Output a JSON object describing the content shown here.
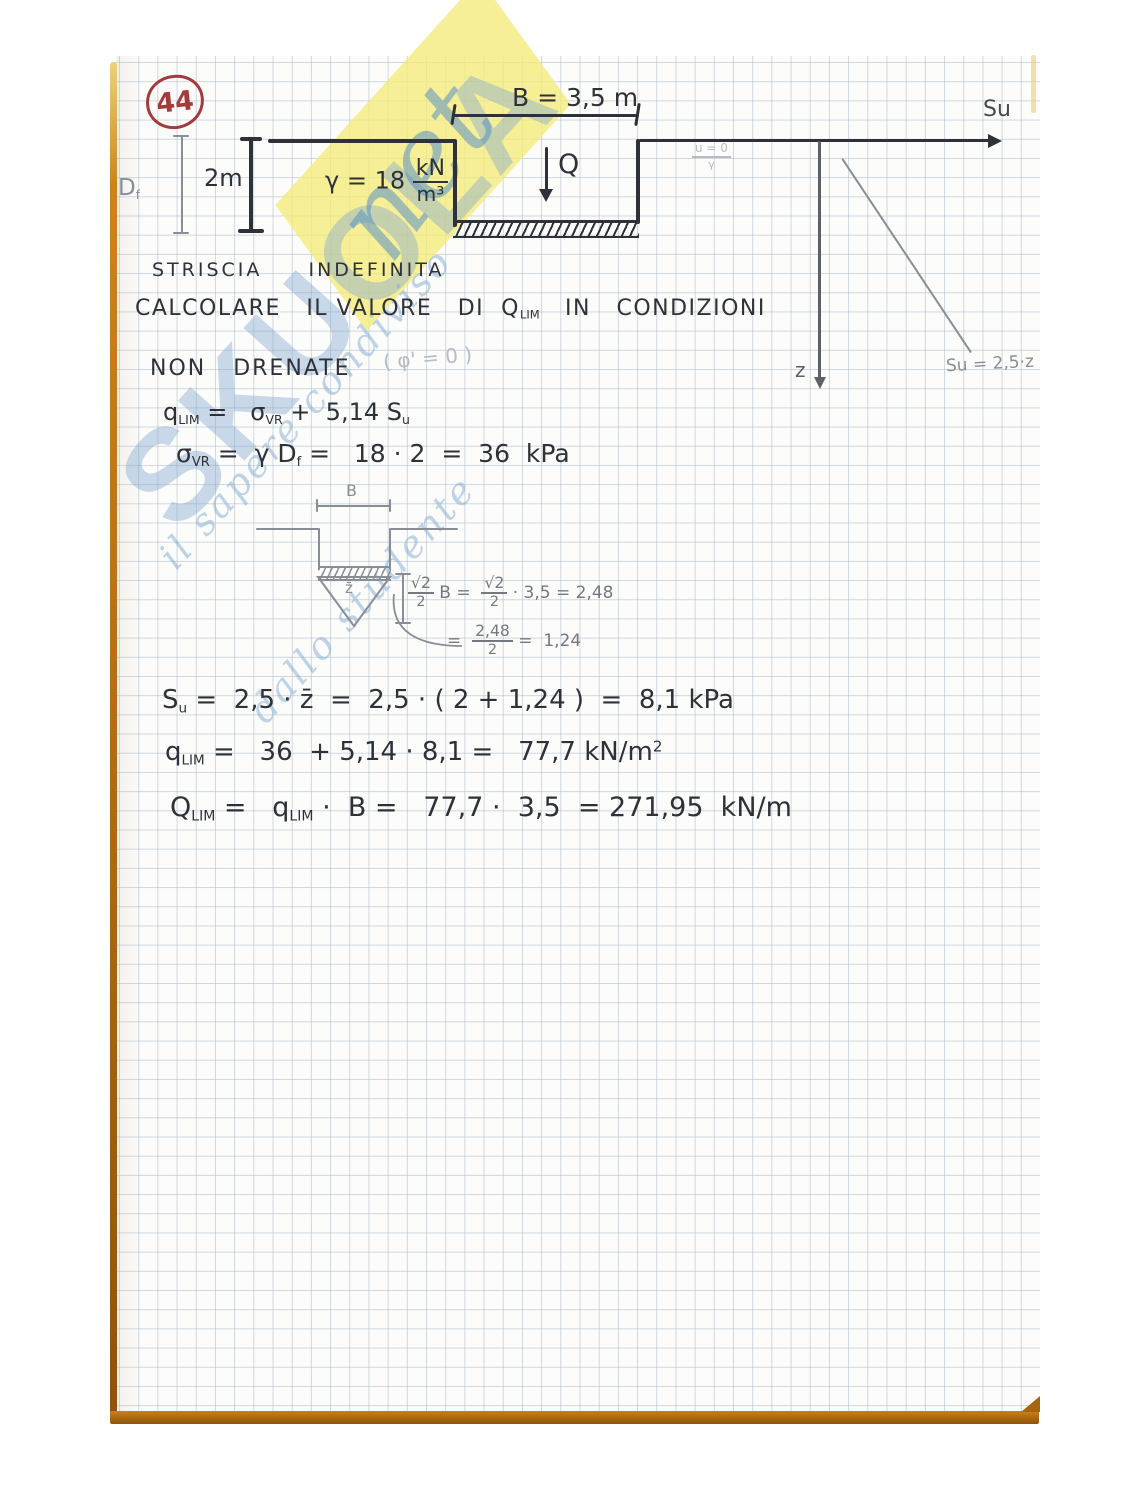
{
  "page": {
    "number": "44"
  },
  "colors": {
    "ink": "#2f3138",
    "pencil": "#898e96",
    "pencil_faint": "#b7bcc4",
    "zaxis": "#5d6167",
    "red": "#a33a3c",
    "border_orange": "#b06a10",
    "grid": "rgba(170,184,197,0.55)",
    "wm_blue": "rgba(128,168,208,0.42)",
    "wm_blue_script": "rgba(90,144,198,0.55)",
    "wm_yellow": "rgba(244,235,122,0.78)",
    "wm_tagline": "rgba(130,170,210,0.5)"
  },
  "watermark": {
    "brand": "SKUOLA",
    "script": "net",
    "tagline_line1": "il sapere condiviso",
    "tagline_line2": "dallo studente"
  },
  "diagram": {
    "dim_b": "B = 3,5 m",
    "depth": "2m",
    "df_label": [
      {
        "t": "D"
      },
      {
        "sub": "f"
      }
    ],
    "gamma_label": [
      {
        "t": "γ = 18 "
      },
      {
        "frac": [
          "kN",
          "m³"
        ]
      }
    ],
    "load": "Q",
    "su_axis": "Su",
    "pore_note": [
      {
        "frac": [
          "u = 0",
          "γ"
        ]
      }
    ],
    "z_axis": "z",
    "profile": "Su = 2,5·z"
  },
  "sketch": {
    "b": "B",
    "zbar": "z̄",
    "eq1": [
      {
        "frac": [
          "√2",
          "2"
        ]
      },
      {
        "t": " B =  "
      },
      {
        "frac": [
          "√2",
          "2"
        ]
      },
      {
        "t": " · 3,5 = 2,48"
      }
    ],
    "eq2": [
      {
        "t": "=  "
      },
      {
        "frac": [
          "2,48",
          "2"
        ]
      },
      {
        "t": " =  1,24"
      }
    ]
  },
  "text": {
    "heading": "STRISCIA  INDEFINITA",
    "task": [
      {
        "t": "CALCOLARE   IL VALORE   DI  Q"
      },
      {
        "sub": "LIM"
      },
      {
        "t": "   IN   CONDIZIONI"
      }
    ],
    "task2": "NON   DRENATE",
    "phi_note": "( φ' = 0 )",
    "eq_qlim": [
      {
        "t": "q"
      },
      {
        "sub": "LIM"
      },
      {
        "t": " =   σ"
      },
      {
        "sub": "VR"
      },
      {
        "t": " +  5,14 S"
      },
      {
        "sub": "u"
      }
    ],
    "eq_sigma": [
      {
        "t": "σ"
      },
      {
        "sub": "VR"
      },
      {
        "t": " =  γ D"
      },
      {
        "sub": "f"
      },
      {
        "t": " =   18 · 2  =  36  kPa"
      }
    ],
    "eq_su": [
      {
        "t": "S"
      },
      {
        "sub": "u"
      },
      {
        "t": " =  2,5 · z̄  =  2,5 · ( 2 + 1,24 )  =  8,1 kPa"
      }
    ],
    "eq_qlim2": [
      {
        "t": "q"
      },
      {
        "sub": "LIM"
      },
      {
        "t": " =   36  + 5,14 · 8,1 =   77,7 kN/m"
      },
      {
        "sup": "2"
      }
    ],
    "eq_Qlim": [
      {
        "t": "Q"
      },
      {
        "sub": "LIM"
      },
      {
        "t": " =   q"
      },
      {
        "sub": "LIM"
      },
      {
        "t": " ·  B =   77,7 ·  3,5  = 271,95  kN/m"
      }
    ]
  }
}
